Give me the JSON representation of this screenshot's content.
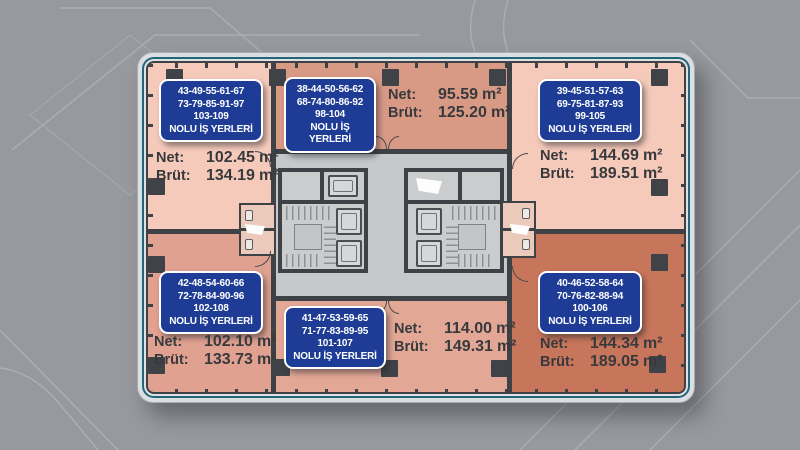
{
  "meta": {
    "area_unit": "m²",
    "net_label": "Net:",
    "brut_label": "Brüt:"
  },
  "colors": {
    "background": "#97999e",
    "plan_frame": "#dcdfe2",
    "plan_outline_teal": "#23667c",
    "wall": "#3e4145",
    "corridor": "#c6c8cb",
    "tag_blue": "#1e3c96",
    "unit_top_left": "#f6cabb",
    "unit_top_middle": "#d89a85",
    "unit_top_right": "#f6cabb",
    "unit_bottom_left": "#e0a190",
    "unit_bottom_middle": "#e2a795",
    "unit_bottom_right": "#c8765b"
  },
  "units": [
    {
      "position": "top-left",
      "numbers": [
        "43-49-55-61-67",
        "73-79-85-91-97",
        "103-109"
      ],
      "title": "NOLU İŞ YERLERİ",
      "net": "102.45",
      "brut": "134.19"
    },
    {
      "position": "top-middle",
      "numbers": [
        "38-44-50-56-62",
        "68-74-80-86-92",
        "98-104"
      ],
      "title": "NOLU İŞ YERLERİ",
      "net": "95.59",
      "brut": "125.20"
    },
    {
      "position": "top-right",
      "numbers": [
        "39-45-51-57-63",
        "69-75-81-87-93",
        "99-105"
      ],
      "title": "NOLU İŞ YERLERİ",
      "net": "144.69",
      "brut": "189.51"
    },
    {
      "position": "bottom-left",
      "numbers": [
        "42-48-54-60-66",
        "72-78-84-90-96",
        "102-108"
      ],
      "title": "NOLU İŞ YERLERİ",
      "net": "102.10",
      "brut": "133.73"
    },
    {
      "position": "bottom-middle",
      "numbers": [
        "41-47-53-59-65",
        "71-77-83-89-95",
        "101-107"
      ],
      "title": "NOLU İŞ YERLERİ",
      "net": "114.00",
      "brut": "149.31"
    },
    {
      "position": "bottom-right",
      "numbers": [
        "40-46-52-58-64",
        "70-76-82-88-94",
        "100-106"
      ],
      "title": "NOLU İŞ YERLERİ",
      "net": "144.34",
      "brut": "189.05"
    }
  ]
}
